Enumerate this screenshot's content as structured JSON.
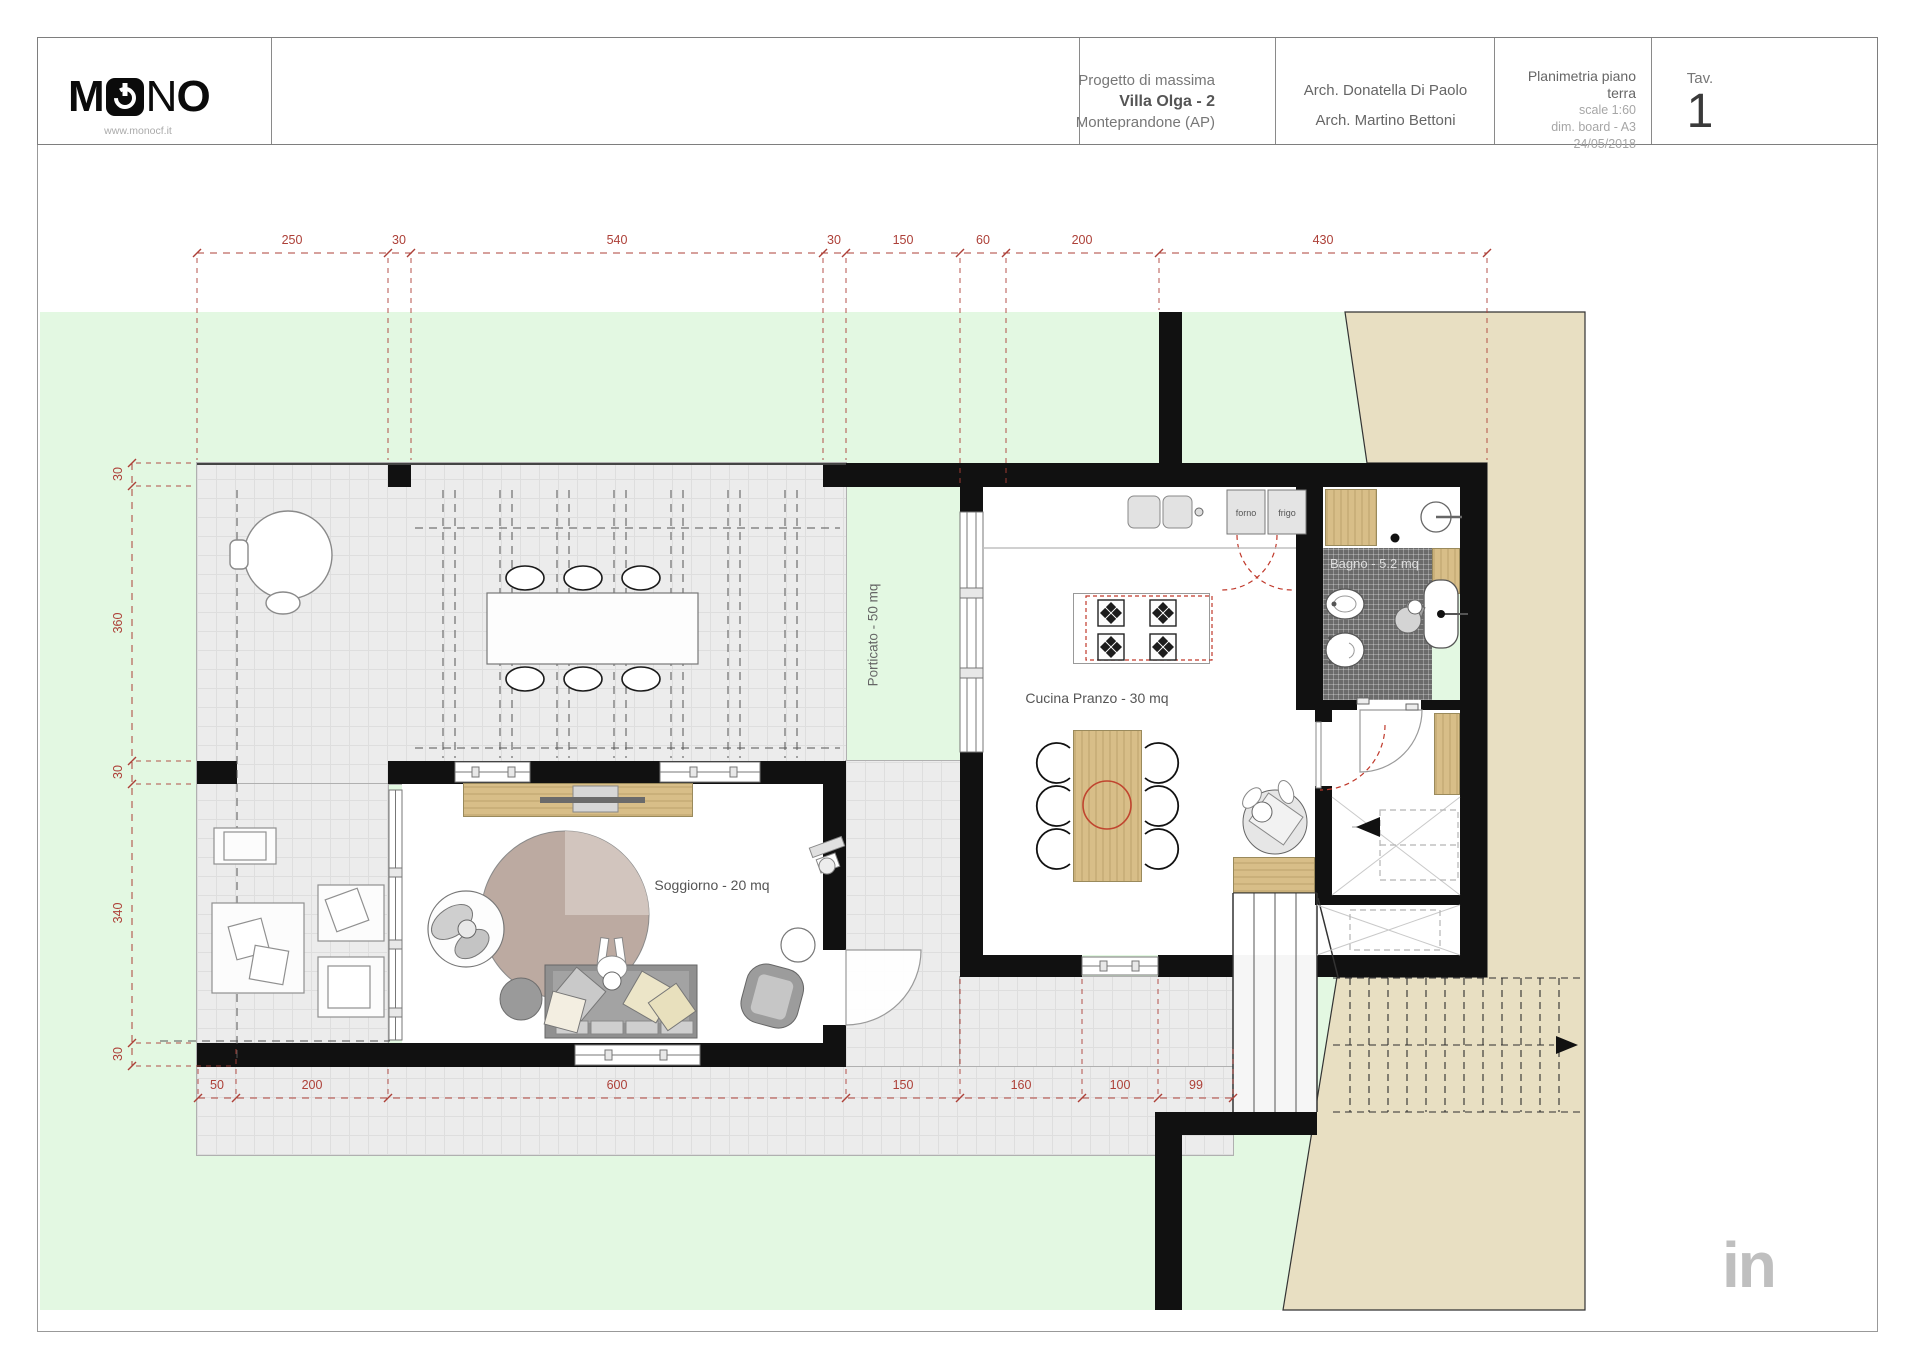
{
  "sheet": {
    "logo": {
      "part1": "M",
      "part2": "N",
      "part3": "O",
      "website": "www.monocf.it"
    },
    "project": {
      "line1": "Progetto di massima",
      "line2": "Villa Olga - 2",
      "line3": "Monteprandone (AP)"
    },
    "architects": {
      "line1": "Arch. Donatella Di Paolo",
      "line2": "Arch. Martino Bettoni"
    },
    "drawing_info": {
      "title": "Planimetria piano terra",
      "scale": "scale 1:60",
      "board": "dim. board - A3",
      "date": "24/05/2018"
    },
    "tav": {
      "label": "Tav.",
      "number": "1"
    }
  },
  "plan": {
    "rooms": {
      "porticato": "Porticato - 50 mq",
      "cucina": "Cucina Pranzo - 30 mq",
      "soggiorno": "Soggiorno - 20 mq",
      "bagno": "Bagno - 5.2 mq"
    },
    "appliances": {
      "oven": "forno",
      "fridge": "frigo"
    },
    "dimensions": {
      "top": [
        "250",
        "30",
        "540",
        "30",
        "150",
        "60",
        "200",
        "430"
      ],
      "left": [
        "30",
        "360",
        "30",
        "340",
        "30"
      ],
      "bottom": [
        "50",
        "200",
        "600",
        "150",
        "160",
        "100",
        "99"
      ]
    }
  },
  "watermark": "in",
  "colors": {
    "lawn": "#e3f8e2",
    "sand": "#e8dfc2",
    "terrace": "#ececec",
    "wall": "#111111",
    "wood": "#d8be88",
    "dimension_red": "#ad4038",
    "bathroom_tile": "#6b6b6b"
  }
}
